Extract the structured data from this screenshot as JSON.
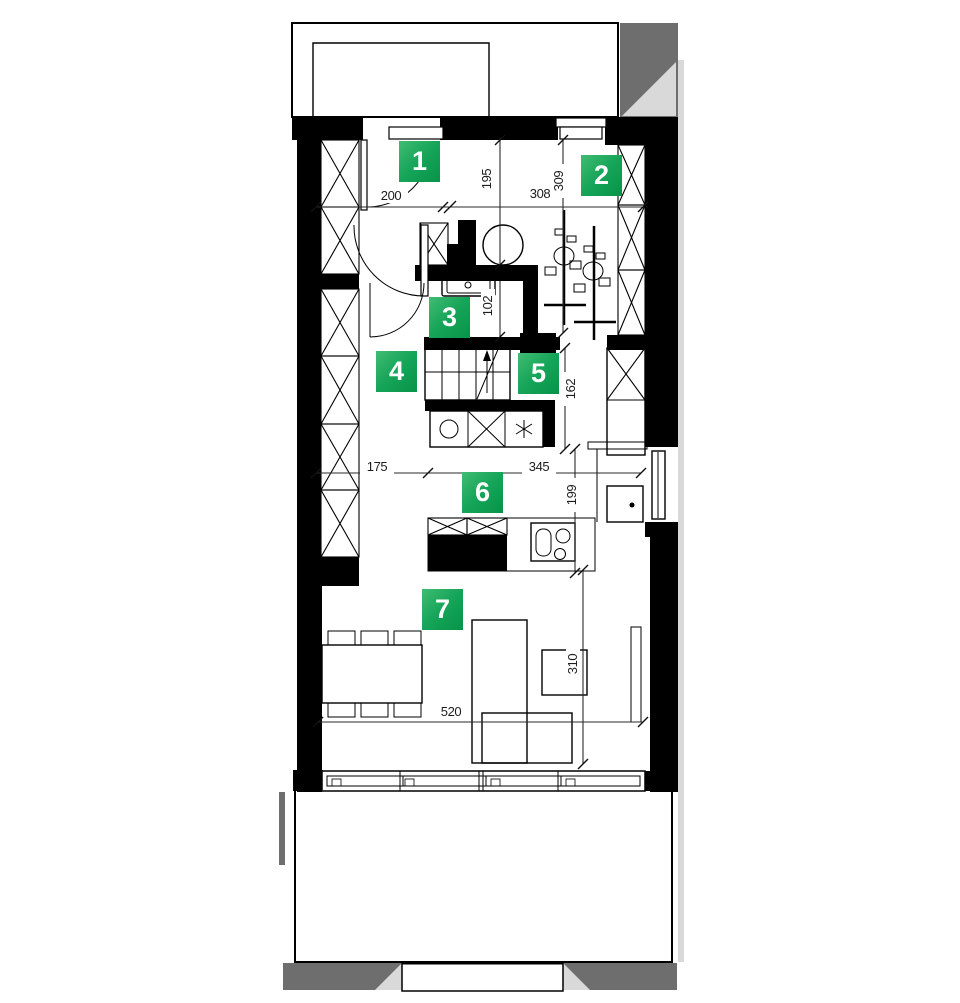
{
  "plan": {
    "markers": [
      {
        "number": "1"
      },
      {
        "number": "2"
      },
      {
        "number": "3"
      },
      {
        "number": "4"
      },
      {
        "number": "5"
      },
      {
        "number": "6"
      },
      {
        "number": "7"
      }
    ],
    "dimensions": {
      "d200": "200",
      "d195": "195",
      "d308": "308",
      "d309": "309",
      "d102": "102",
      "d162": "162",
      "d175": "175",
      "d345": "345",
      "d199": "199",
      "d520": "520",
      "d310": "310"
    },
    "colors": {
      "marker_gradient_start": "#40bc73",
      "marker_gradient_end": "#089448",
      "wall": "#000000",
      "shadow_dark": "#6e6e6e",
      "shadow_light": "#d9d9d9"
    }
  }
}
